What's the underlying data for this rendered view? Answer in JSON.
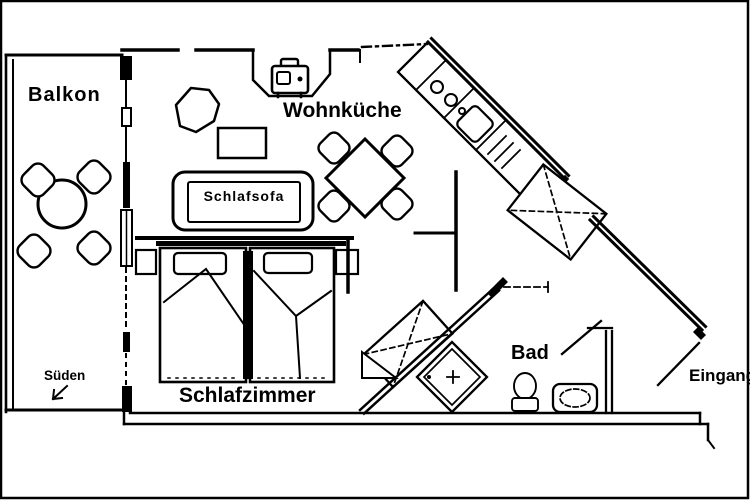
{
  "meta": {
    "type": "apartment-floor-plan",
    "background_color": "#ffffff",
    "ink_color": "#000000"
  },
  "rooms": {
    "balkon": {
      "label": "Balkon"
    },
    "wohnkueche": {
      "label": "Wohnküche"
    },
    "schlafzimmer": {
      "label": "Schlafzimmer"
    },
    "bad": {
      "label": "Bad"
    },
    "eingang": {
      "label": "Eingang"
    },
    "orientation": {
      "label": "Süden",
      "arrow": "southwest"
    }
  },
  "furniture": {
    "schlafsofa": {
      "label": "Schlafsofa"
    },
    "icons": [
      "tv-icon",
      "armchair-icon",
      "coffee-table-icon",
      "sofa-icon",
      "dining-table-icon",
      "dining-chair-icon",
      "balcony-table-icon",
      "balcony-chair-icon",
      "double-bed-icon",
      "pillow-icon",
      "nightstand-icon",
      "stove-burners-icon",
      "kitchen-sink-icon",
      "appliance-icon",
      "wardrobe-icon",
      "shower-icon",
      "toilet-icon",
      "washbasin-icon",
      "entrance-door-icon",
      "southwest-arrow-icon"
    ]
  }
}
